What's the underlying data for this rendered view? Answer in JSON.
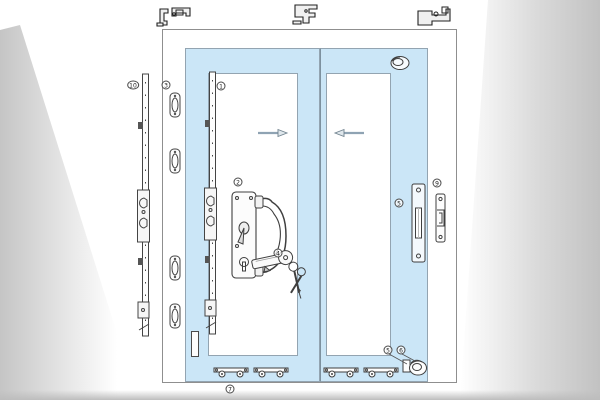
{
  "diagram": {
    "type": "sliding-patio-door-hardware-installation-diagram",
    "colors": {
      "panel_blue": "#cbe6f7",
      "line_art": "#3f3f3f",
      "frame_border": "#8f8f8f",
      "arrow_fill": "#dfe7ec",
      "arrow_stroke": "#71838f",
      "shading_gray": "#c5c5c5"
    }
  },
  "callouts": {
    "c1": "1",
    "c2": "2",
    "c3": "3",
    "c4": "4",
    "c5_keep": "5",
    "c5_corner": "5",
    "c6": "6",
    "c7": "7",
    "c9": "9",
    "c10": "10"
  },
  "parts": {
    "outer_lock_bar": "multipoint-lock-bar",
    "sash_lock_bar": "multipoint-lock-bar",
    "keeper_plates": "keeper-plate",
    "handle_set": "patio-door-handle-set",
    "cylinder_keys": "euro-cylinder-with-keys",
    "mortise_keep": "mortise-keep-plate",
    "jamb_keeper": "hook-keeper",
    "top_latch": "anti-lift-latch",
    "corner_latch": "corner-latch",
    "rollers": "tandem-roller",
    "profiles": "extrusion-cross-section",
    "arrows": "slide-direction-arrows"
  }
}
